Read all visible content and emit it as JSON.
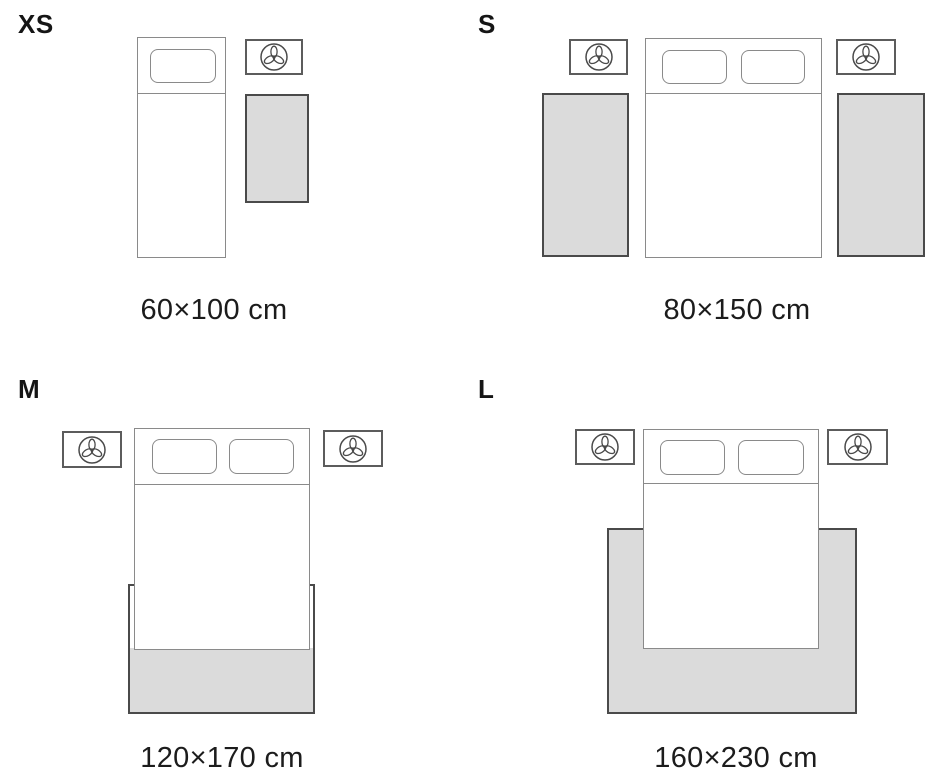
{
  "guide": {
    "sizes": [
      {
        "id": "xs",
        "label": "XS",
        "dimensions": "60×100 cm",
        "layout": "single bed with one nightstand, rug beside bed"
      },
      {
        "id": "s",
        "label": "S",
        "dimensions": "80×150 cm",
        "layout": "double bed with two nightstands, runner rug each side"
      },
      {
        "id": "m",
        "label": "M",
        "dimensions": "120×170 cm",
        "layout": "double bed with two nightstands, rug under foot of bed"
      },
      {
        "id": "l",
        "label": "L",
        "dimensions": "160×230 cm",
        "layout": "double bed with two nightstands, large rug under bed"
      }
    ]
  },
  "icons": {
    "nightstand_decor": "plant-trefoil-icon"
  },
  "colors": {
    "background": "#ffffff",
    "text": "#1c1c1c",
    "rug_fill": "#dbdbdb",
    "rug_border": "#4a4a4a",
    "bed_border": "#8a8a8a",
    "nightstand_border": "#5c5c5c",
    "icon_stroke": "#4a4a4a"
  }
}
